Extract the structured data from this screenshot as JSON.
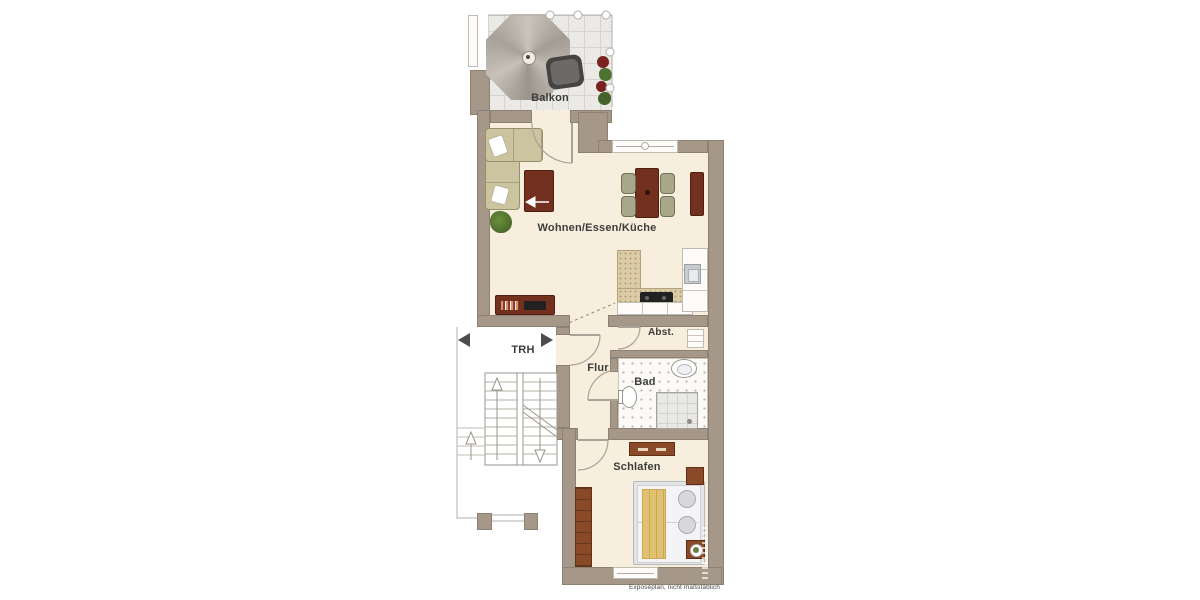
{
  "plan": {
    "disclaimer": "Exposéplan, nicht maßstäblich",
    "rooms": {
      "balkon": {
        "label": "Balkon"
      },
      "wohnen": {
        "label": "Wohnen/Essen/Küche"
      },
      "trh": {
        "label": "TRH"
      },
      "flur": {
        "label": "Flur"
      },
      "abst": {
        "label": "Abst."
      },
      "bad": {
        "label": "Bad"
      },
      "schlafen": {
        "label": "Schlafen"
      }
    },
    "colors": {
      "wall": "#a59889",
      "wall-dark": "#8d8173",
      "floor": "#f8eedd",
      "tile": "#eae9e6",
      "wood-dark": "#74301e",
      "wood-mid": "#8a4a28",
      "sofa": "#ccc49e",
      "counter": "#dbcba6",
      "chair": "#a8a78a",
      "plant": "#4e7230",
      "text": "#3c3c3c"
    }
  }
}
